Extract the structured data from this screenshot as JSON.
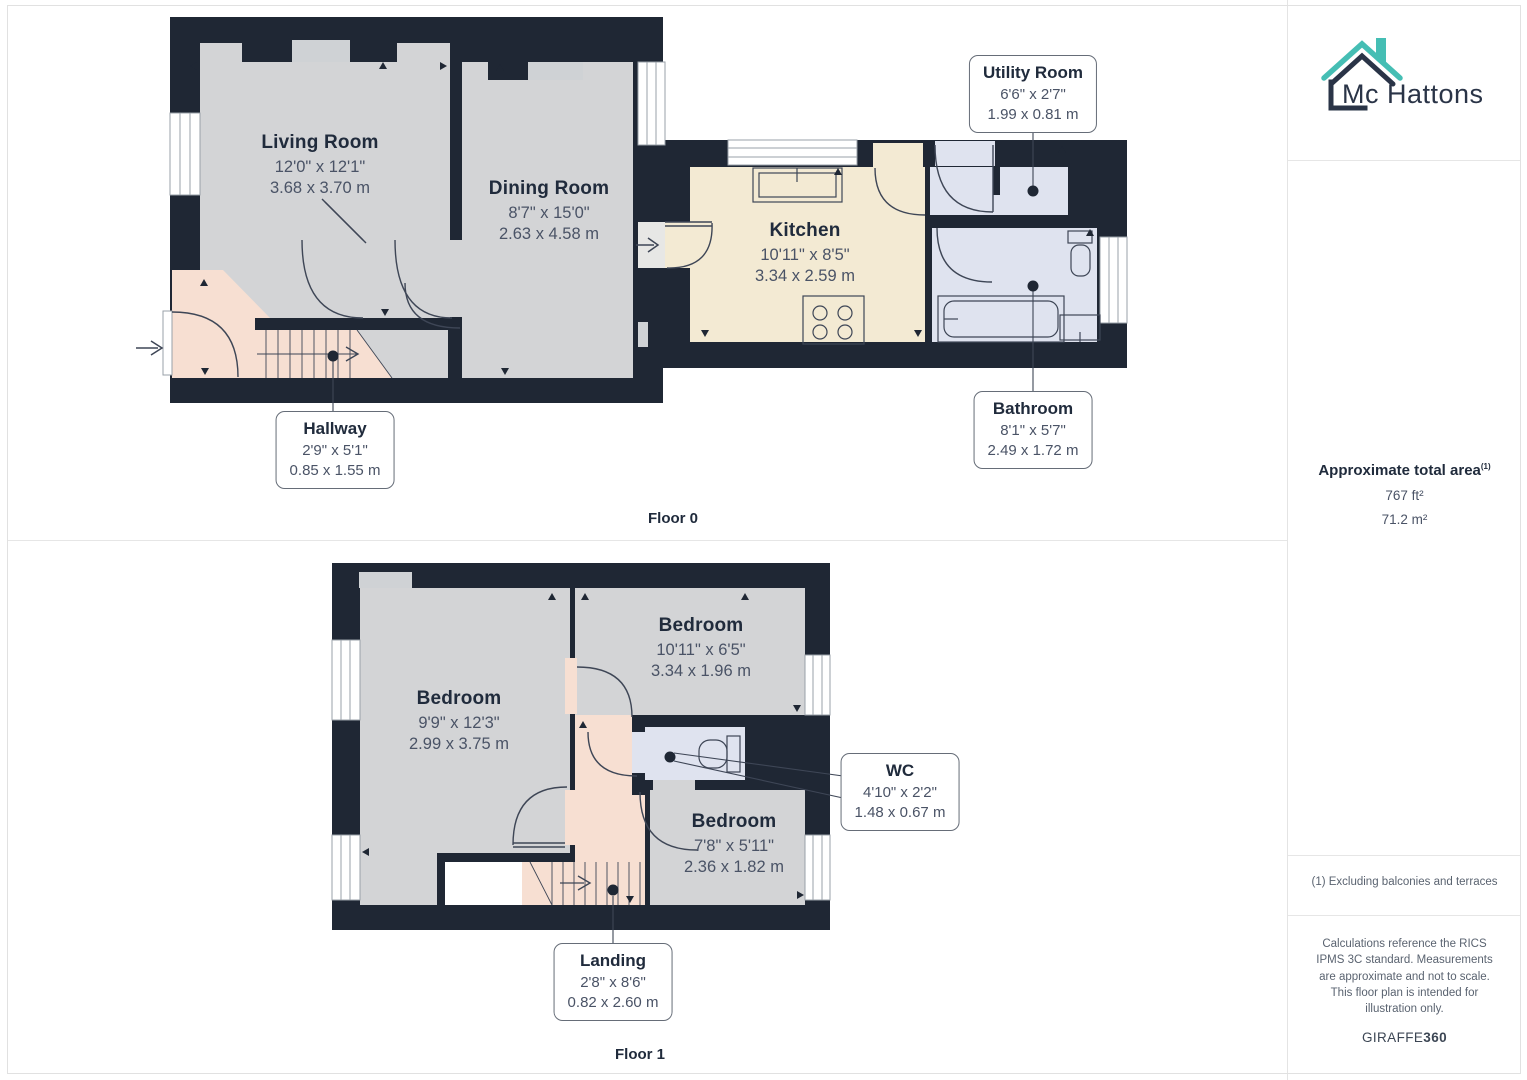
{
  "brand": {
    "name": "Mc Hattons"
  },
  "colors": {
    "wall": "#1f2734",
    "room_gray": "#d3d4d6",
    "kitchen_cream": "#f3ead3",
    "hall_peach": "#f7dfd2",
    "bath_lavender": "#dfe3ef",
    "recess_gray": "#cfd2d5",
    "brand_teal": "#45beb4",
    "brand_navy": "#2a3447",
    "line": "#3e4656"
  },
  "floors": [
    {
      "label": "Floor 0",
      "rooms_inline": [
        {
          "name": "Living Room",
          "imperial": "12'0\" x 12'1\"",
          "metric": "3.68 x 3.70 m"
        },
        {
          "name": "Dining Room",
          "imperial": "8'7\" x 15'0\"",
          "metric": "2.63 x 4.58 m"
        },
        {
          "name": "Kitchen",
          "imperial": "10'11\" x 8'5\"",
          "metric": "3.34 x 2.59 m"
        }
      ],
      "callouts": [
        {
          "name": "Utility Room",
          "imperial": "6'6\" x 2'7\"",
          "metric": "1.99 x 0.81 m"
        },
        {
          "name": "Bathroom",
          "imperial": "8'1\" x 5'7\"",
          "metric": "2.49 x 1.72 m"
        },
        {
          "name": "Hallway",
          "imperial": "2'9\" x 5'1\"",
          "metric": "0.85 x 1.55 m"
        }
      ]
    },
    {
      "label": "Floor 1",
      "rooms_inline": [
        {
          "name": "Bedroom",
          "imperial": "9'9\" x 12'3\"",
          "metric": "2.99 x 3.75 m"
        },
        {
          "name": "Bedroom",
          "imperial": "10'11\" x 6'5\"",
          "metric": "3.34 x 1.96 m"
        },
        {
          "name": "Bedroom",
          "imperial": "7'8\" x 5'11\"",
          "metric": "2.36 x 1.82 m"
        }
      ],
      "callouts": [
        {
          "name": "WC",
          "imperial": "4'10\" x 2'2\"",
          "metric": "1.48 x 0.67 m"
        },
        {
          "name": "Landing",
          "imperial": "2'8\" x 8'6\"",
          "metric": "0.82 x 2.60 m"
        }
      ]
    }
  ],
  "sidebar": {
    "total_area": {
      "label": "Approximate total area",
      "marker": "(1)",
      "imperial": "767 ft²",
      "metric": "71.2 m²"
    },
    "footnote": "(1) Excluding balconies and terraces",
    "disclaimer": "Calculations reference the RICS IPMS 3C standard. Measurements are approximate and not to scale. This floor plan is intended for illustration only.",
    "provider": "GIRAFFE",
    "provider_suffix": "360"
  }
}
